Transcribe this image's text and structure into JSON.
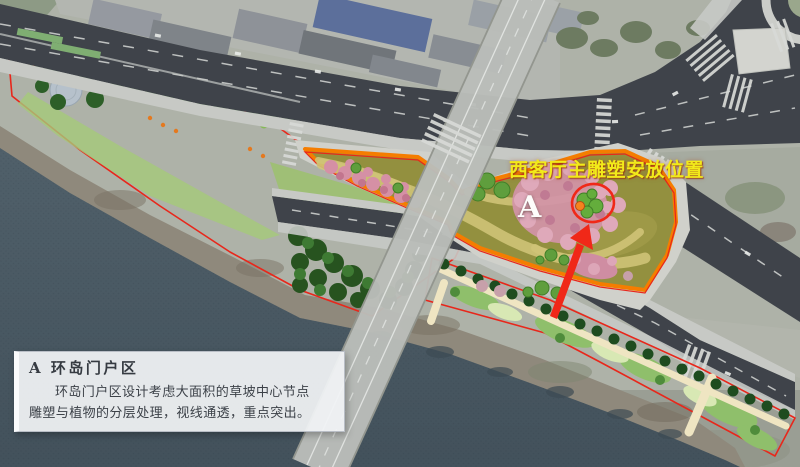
{
  "annotations": {
    "sculpture_location_label": "西客厅主雕塑安放位置",
    "zone_marker": "A"
  },
  "legend": {
    "title": "A 环岛门户区",
    "body": "环岛门户区设计考虑大面积的草坡中心节点雕塑与植物的分层处理，视线通透，重点突出。"
  },
  "colors": {
    "water": "#50606a",
    "road": "#3f434a",
    "sidewalk": "#c7c9c5",
    "bridge": "#babdb9",
    "park_green": "#74a851",
    "lawn_light": "#a9cc7d",
    "forest_dark": "#27531f",
    "zone_grass": "#93903f",
    "zone_path": "#cfc377",
    "pink_planting": "#d394a8",
    "cream_path": "#efe5c2",
    "outline_red": "#e8271b",
    "outline_orange": "#f57d00",
    "arrow_red": "#f02818",
    "label_yellow": "#f2ea1a",
    "legend_text": "#3c4148"
  }
}
